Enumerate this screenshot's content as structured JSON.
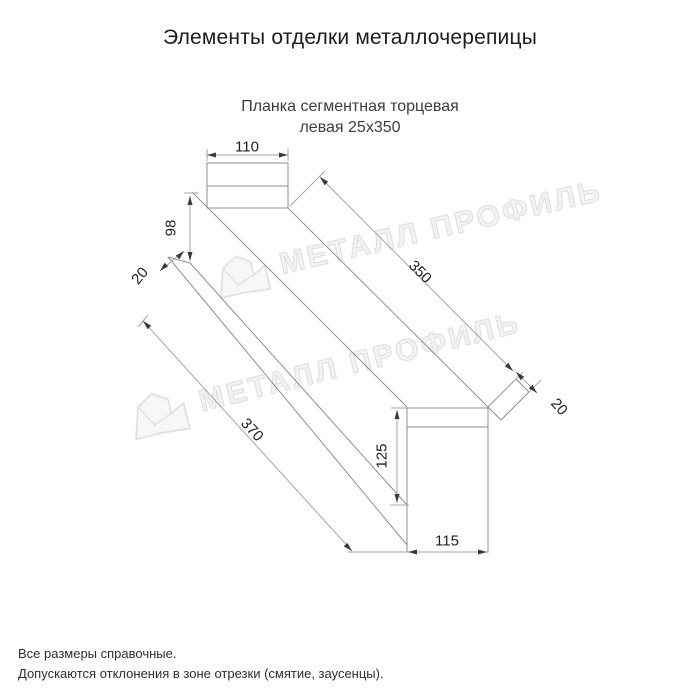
{
  "header": {
    "title": "Элементы отделки металлочерепицы"
  },
  "subtitle": {
    "line1": "Планка сегментная торцевая",
    "line2": "левая 25х350"
  },
  "drawing": {
    "dims": {
      "top_width": "110",
      "left_height": "98",
      "left_fold": "20",
      "bottom_length": "370",
      "top_length": "350",
      "right_fold": "20",
      "right_height": "125",
      "bottom_width": "115"
    }
  },
  "watermark": {
    "text": "МЕТАЛЛ ПРОФИЛЬ"
  },
  "notes": {
    "line1": "Все размеры справочные.",
    "line2": "Допускаются отклонения в зоне отрезки (смятие, заусенцы)."
  },
  "colors": {
    "part_line": "#8f8f8f",
    "dim_line": "#a6a6a6",
    "arrow": "#3a3a3a",
    "text": "#1f1f1f",
    "watermark": "#dcdcdc"
  }
}
